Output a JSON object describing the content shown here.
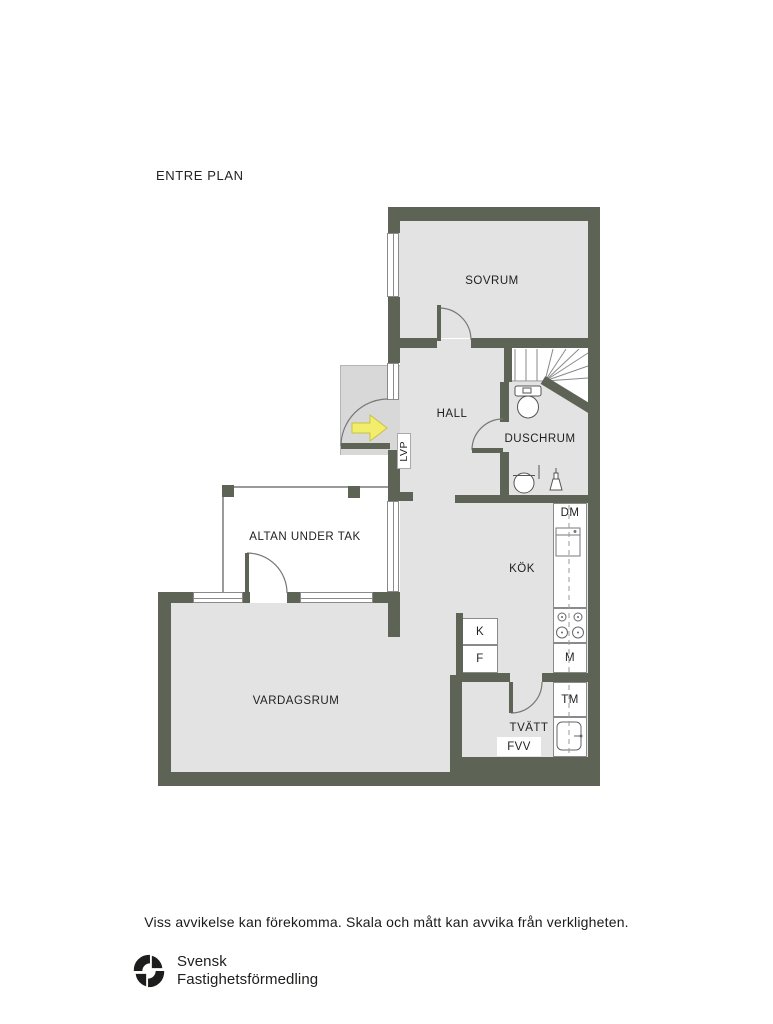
{
  "title": "ENTRE PLAN",
  "rooms": {
    "sovrum": "SOVRUM",
    "hall": "HALL",
    "duschrum": "DUSCHRUM",
    "kok": "KÖK",
    "vardagsrum": "VARDAGSRUM",
    "altan": "ALTAN UNDER TAK",
    "tvatt": "TVÄTT"
  },
  "labels": {
    "lvp": "LVP",
    "dm": "DM",
    "m": "M",
    "tm": "TM",
    "k": "K",
    "f": "F",
    "fvv": "FVV"
  },
  "disclaimer": "Viss avvikelse kan förekomma. Skala och mått kan avvika från verkligheten.",
  "brand": {
    "name_line1": "Svensk",
    "name_line2": "Fastighetsförmedling"
  },
  "colors": {
    "wall": "#5e6455",
    "floor": "#e3e3e3",
    "porch": "#d8d8d8",
    "patio": "#ffffff",
    "arrow": "#f2ee6b",
    "text": "#1f1f1f"
  }
}
